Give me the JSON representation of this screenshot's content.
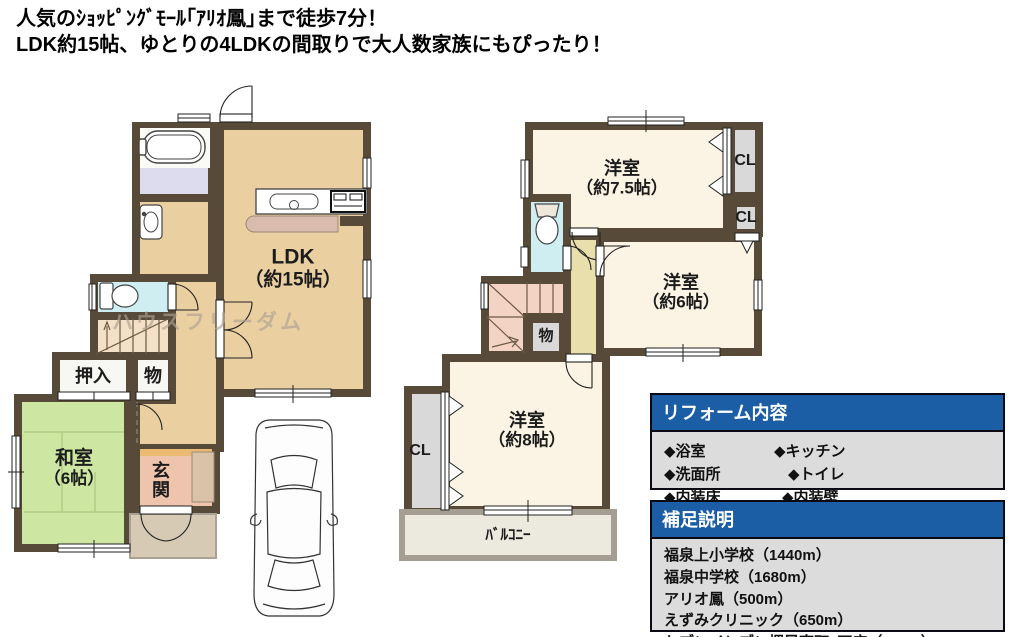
{
  "header": {
    "line1": "人気のｼｮｯﾋﾟﾝｸﾞﾓｰﾙ｢ｱﾘｵ鳳｣まで徒歩7分！",
    "line2": "LDK約15帖、ゆとりの4LDKの間取りで大人数家族にもぴったり！"
  },
  "watermark": "ハウスフリーダム",
  "floor1": {
    "ldk": {
      "name": "LDK",
      "size": "（約15帖）"
    },
    "washitsu": {
      "name": "和室",
      "size": "（6帖）"
    },
    "genkan": "玄関",
    "oshiire": "押入",
    "storage": "物"
  },
  "floor2": {
    "room75": {
      "name": "洋室",
      "size": "（約7.5帖）"
    },
    "room6": {
      "name": "洋室",
      "size": "（約6帖）"
    },
    "room8": {
      "name": "洋室",
      "size": "（約8帖）"
    },
    "closet_top": "CL",
    "closet_mid": "CL",
    "closet_room8": "CL",
    "storage": "物",
    "balcony": "ﾊﾞﾙｺﾆｰ"
  },
  "reform_box": {
    "title": "リフォーム内容",
    "items": [
      "◆浴室",
      "◆キッチン",
      "◆洗面所",
      "◆トイレ",
      "◆内装床",
      "◆内装壁"
    ]
  },
  "note_box": {
    "title": "補足説明",
    "lines": [
      "福泉上小学校（1440m）",
      "福泉中学校（1680m）",
      "アリオ鳳（500m）",
      "えずみクリニック（650m）",
      "セブンイレブン堺鳳南町3丁店（510m）"
    ]
  },
  "colors": {
    "wall": "#574a38",
    "tan_floor": "#eacfa0",
    "tatami_green": "#cde7a3",
    "bath_lavender": "#dcdcee",
    "toilet_cyan": "#cfeef2",
    "genkan_salmon": "#eec4ac",
    "cream_room": "#fbf3e3",
    "hall_khaki": "#e9dfad",
    "closet_gray": "#d9d9d9",
    "stairs_pink": "#f3d3c3",
    "header_blue": "#1b5ea6",
    "box_gray": "#dcdcdc"
  }
}
